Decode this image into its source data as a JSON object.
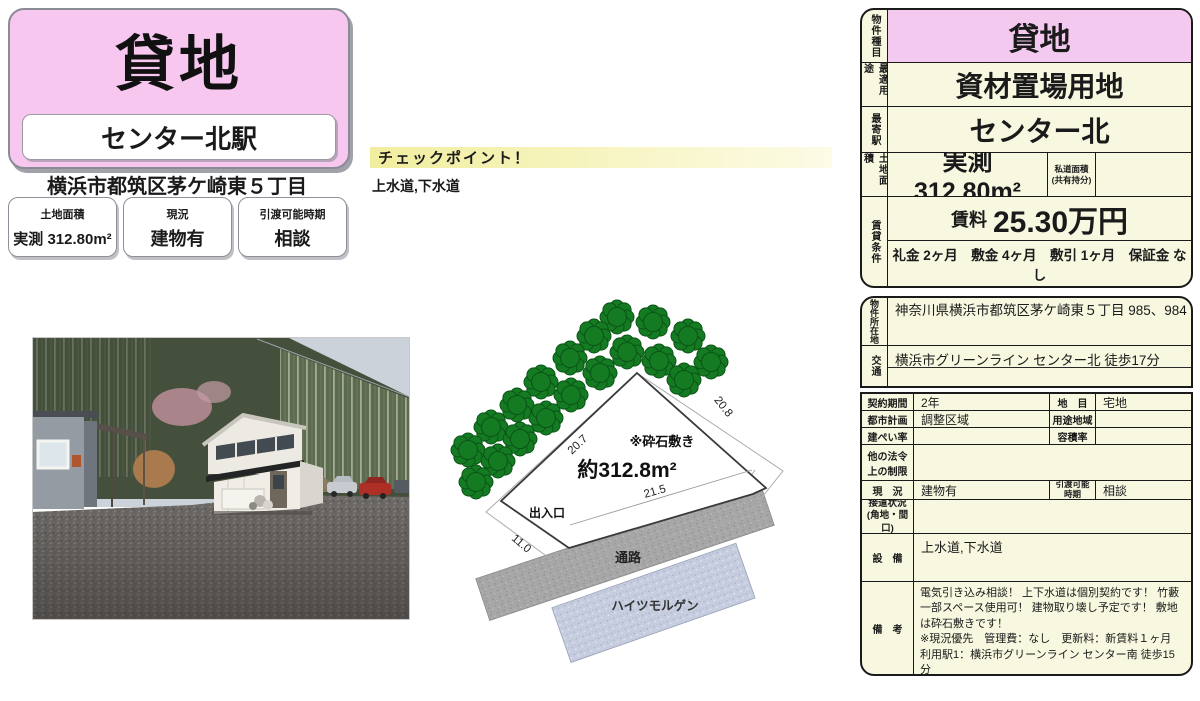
{
  "left_header": {
    "property_type": "貸地",
    "station": "センター北駅",
    "address": "横浜市都筑区茅ケ崎東５丁目",
    "badges": [
      {
        "label": "土地面積",
        "value": "実測 312.80m²"
      },
      {
        "label": "現況",
        "value": "建物有"
      },
      {
        "label": "引渡可能時期",
        "value": "相談"
      }
    ]
  },
  "checkpoint": {
    "title": "チェックポイント！",
    "body": "上水道,下水道"
  },
  "summary_table": {
    "property_type": {
      "label": "物件種目",
      "value": "貸地"
    },
    "best_use": {
      "label": "最適用途",
      "value": "資材置場用地"
    },
    "nearest_station": {
      "label": "最寄駅",
      "value": "センター北"
    },
    "land_area": {
      "label": "土地面積",
      "value": "実測 312.80m²",
      "private_road_label": "私道面積\n(共有持分)",
      "private_road_value": ""
    },
    "lease": {
      "label": "賃貸条件",
      "rent_label": "賃料",
      "rent_value": "25.30万円",
      "terms": "礼金 2ヶ月　敷金 4ヶ月　敷引 1ヶ月　保証金 なし"
    }
  },
  "detail_table": {
    "location": {
      "label": "物件所在地",
      "value": "神奈川県横浜市都筑区茅ケ崎東５丁目 985、984"
    },
    "access": {
      "label": "交通",
      "value": "横浜市グリーンライン センター北 徒歩17分"
    },
    "contract_period": {
      "label": "契約期間",
      "value": "2年"
    },
    "land_category": {
      "label": "地　目",
      "value": "宅地"
    },
    "city_planning": {
      "label": "都市計画",
      "value": "調整区域"
    },
    "use_district": {
      "label": "用途地域",
      "value": ""
    },
    "building_coverage": {
      "label": "建ぺい率",
      "value": ""
    },
    "floor_area_ratio": {
      "label": "容積率",
      "value": ""
    },
    "other_restrictions": {
      "label": "他の法令\n上の制限",
      "value": ""
    },
    "current_state": {
      "label": "現　況",
      "value": "建物有"
    },
    "handover": {
      "label": "引渡可能\n時期",
      "value": "相談"
    },
    "road_contact": {
      "label": "接道状況\n(角地・間口)",
      "value": ""
    },
    "facilities": {
      "label": "設　備",
      "value": "上水道,下水道"
    },
    "remarks": {
      "label": "備　考",
      "value": "電気引き込み相談！ 上下水道は個別契約です！ 竹藪一部スペース使用可！ 建物取り壊し予定です！ 敷地は砕石敷きです！\n※現況優先　管理費：なし　更新料：新賃料１ヶ月　利用駅1：横浜市グリーンライン センター南 徒歩15分"
    }
  },
  "site_plan": {
    "area": "約312.8m²",
    "surface": "※砕石敷き",
    "entrance": "出入口",
    "dim_nw": "20.7",
    "dim_ne": "20.8",
    "dim_s": "21.5",
    "dim_sw": "11.0",
    "road": "通路",
    "neighbor_building": "ハイツモルゲン"
  },
  "colors": {
    "pink": "#f4c9ef",
    "cream": "#f8f7e0",
    "tree_green": "#157b23",
    "road_gray": "#a7a7a7",
    "neighbor_blue": "#c6cddf"
  }
}
